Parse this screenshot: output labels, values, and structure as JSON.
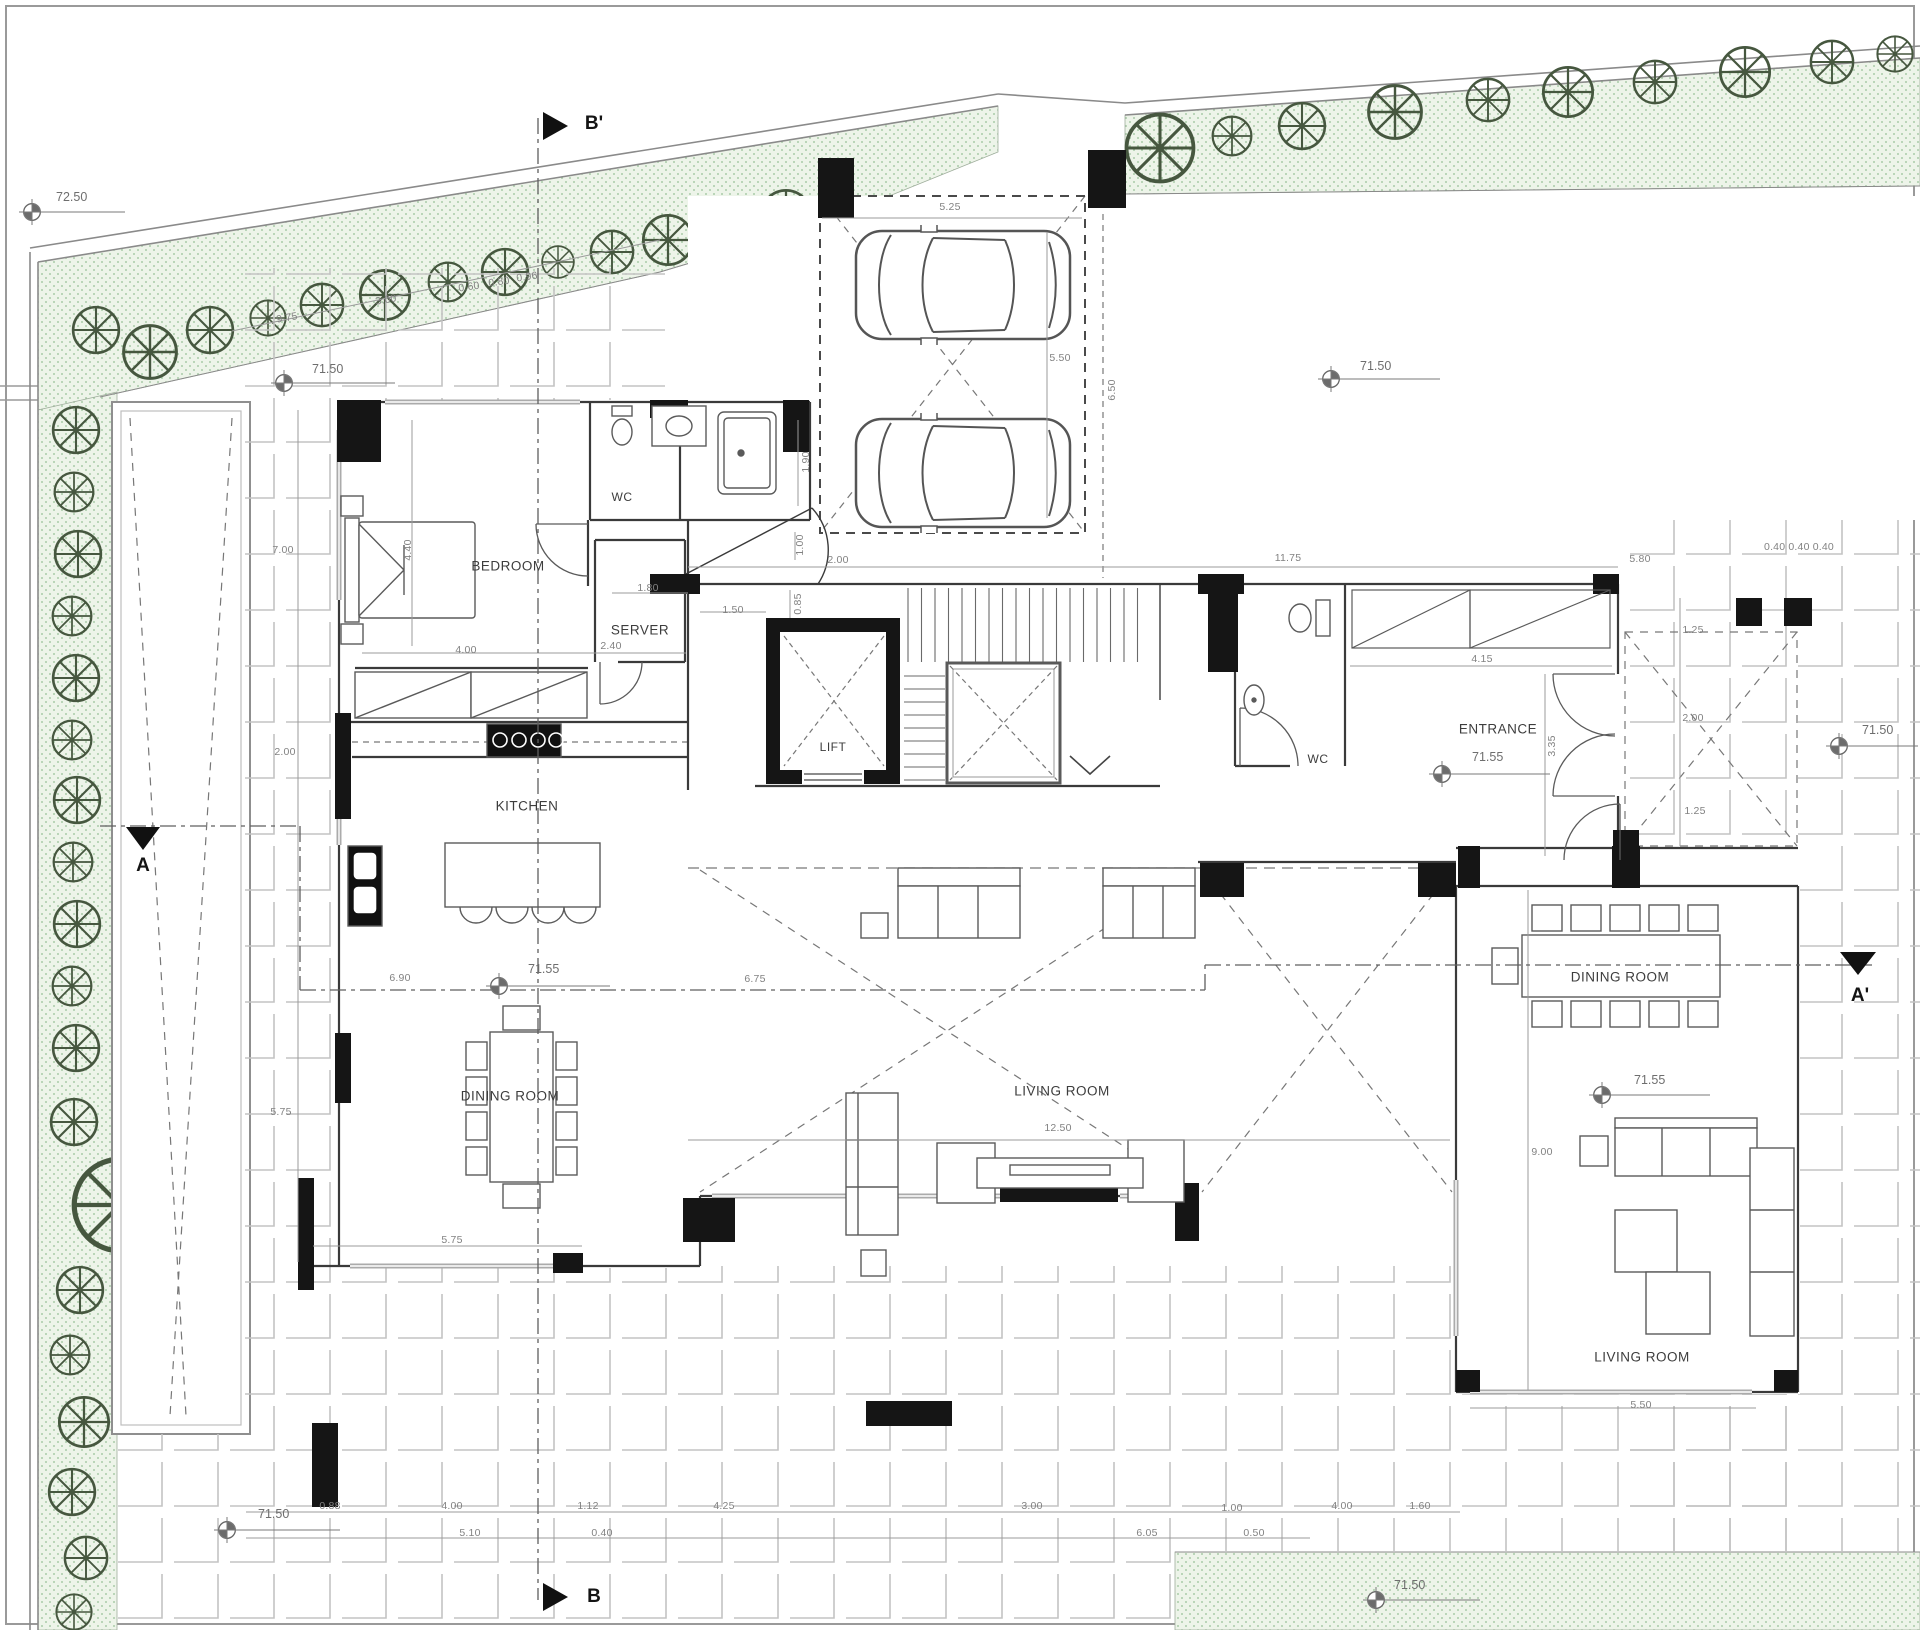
{
  "plan": {
    "rooms": {
      "bedroom": "BEDROOM",
      "wc_top": "WC",
      "server": "SERVER",
      "kitchen": "KITCHEN",
      "dining_left": "DINING ROOM",
      "lift": "LIFT",
      "wc_entrance": "WC",
      "entrance": "ENTRANCE",
      "living_center": "LIVING ROOM",
      "dining_right": "DINING ROOM",
      "living_right": "LIVING ROOM"
    },
    "sections": {
      "top": "B'",
      "bottom": "B",
      "left": "A",
      "right": "A'"
    },
    "levels": [
      {
        "v": "72.50"
      },
      {
        "v": "71.50"
      },
      {
        "v": "71.50"
      },
      {
        "v": "71.55"
      },
      {
        "v": "71.55"
      },
      {
        "v": "71.50"
      },
      {
        "v": "71.55"
      },
      {
        "v": "71.50"
      },
      {
        "v": "71.50"
      }
    ],
    "dimensions": [
      {
        "v": "9.75"
      },
      {
        "v": "3.00"
      },
      {
        "v": "0.60"
      },
      {
        "v": "0.80"
      },
      {
        "v": "0.96"
      },
      {
        "v": "5.25"
      },
      {
        "v": "5.50"
      },
      {
        "v": "6.50"
      },
      {
        "v": "1.90"
      },
      {
        "v": "1.00"
      },
      {
        "v": "2.00"
      },
      {
        "v": "0.85"
      },
      {
        "v": "1.50"
      },
      {
        "v": "1.80"
      },
      {
        "v": "2.40"
      },
      {
        "v": "4.00"
      },
      {
        "v": "4.40"
      },
      {
        "v": "7.00"
      },
      {
        "v": "2.00"
      },
      {
        "v": "5.75"
      },
      {
        "v": "6.90"
      },
      {
        "v": "6.75"
      },
      {
        "v": "12.50"
      },
      {
        "v": "11.75"
      },
      {
        "v": "5.80"
      },
      {
        "v": "0.40 0.40 0.40"
      },
      {
        "v": "4.15"
      },
      {
        "v": "3.35"
      },
      {
        "v": "1.25"
      },
      {
        "v": "2.00"
      },
      {
        "v": "1.25"
      },
      {
        "v": "9.00"
      },
      {
        "v": "5.50"
      },
      {
        "v": "5.75"
      },
      {
        "v": "0.88"
      },
      {
        "v": "4.00"
      },
      {
        "v": "1.12"
      },
      {
        "v": "4.25"
      },
      {
        "v": "3.00"
      },
      {
        "v": "1.00"
      },
      {
        "v": "4.00"
      },
      {
        "v": "1.60"
      },
      {
        "v": "5.10"
      },
      {
        "v": "0.40"
      },
      {
        "v": "6.05"
      },
      {
        "v": "0.50"
      }
    ],
    "colors": {
      "planting": "#edf4e9",
      "planting_dot": "#96bf96",
      "line": "#3a3a3a",
      "tile": "#c3c3c3"
    }
  }
}
